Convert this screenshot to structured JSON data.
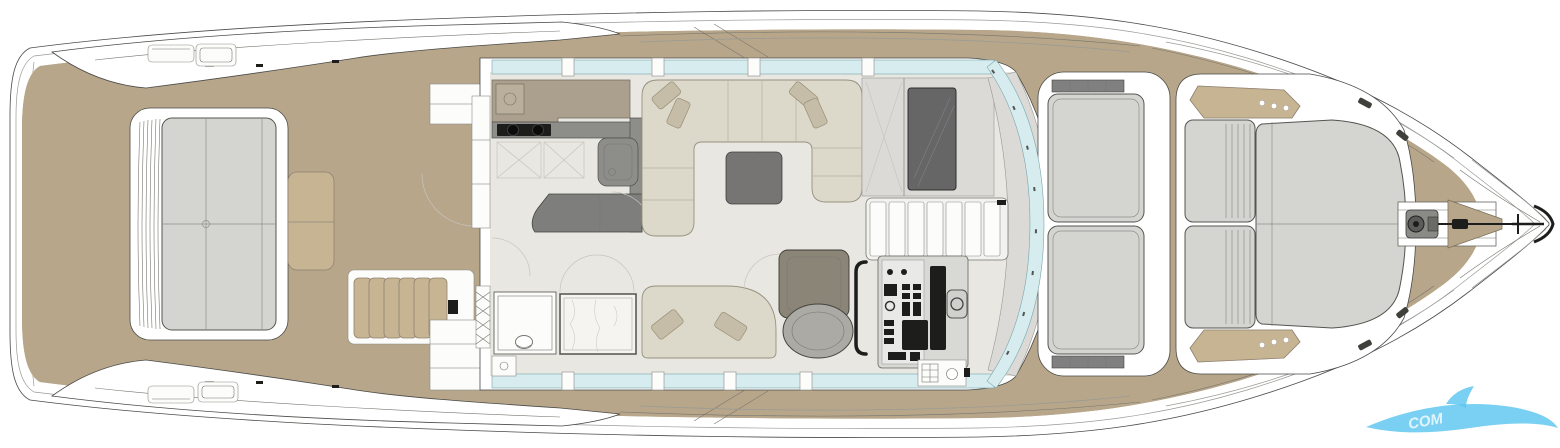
{
  "colors": {
    "teak": "#b7a689",
    "teak_plank": "#99896e",
    "teak_light": "#c6b493",
    "hull_line": "#4a4a48",
    "contour": "#9a9a96",
    "floor": "#e8e7e2",
    "wall": "#dbdad6",
    "glass": "#d6ecef",
    "cushion": "#d4d4d1",
    "cushion_edge": "#55544f",
    "sofa": "#dcd8ca",
    "pillow": "#c6bda8",
    "counter_tan": "#aba08d",
    "counter_dark": "#8d8d8a",
    "island_dark": "#7e7e7c",
    "table_dark": "#767573",
    "dark": "#1d1d1c",
    "chair": "#8b8578",
    "marble": "#f5f4f1",
    "logo_blue": "#57c4ef"
  },
  "planks": {
    "spacing": 5
  },
  "watermark": {
    "text": "COM"
  }
}
